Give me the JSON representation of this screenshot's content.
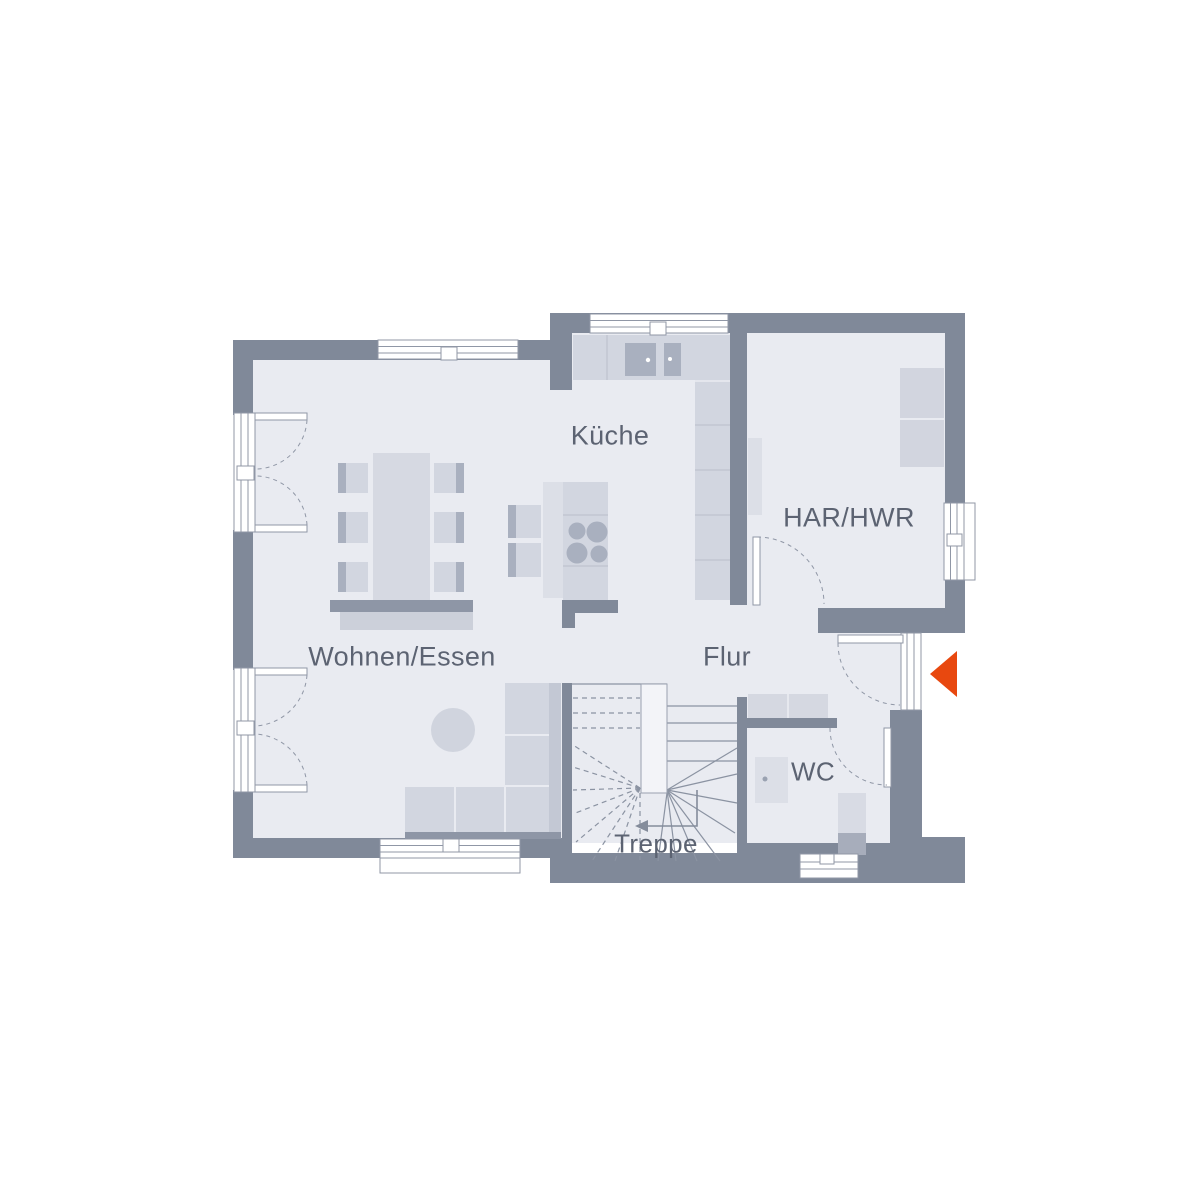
{
  "plan": {
    "type": "floor-plan-ground-floor",
    "labels": {
      "kueche": "Küche",
      "har_hwr": "HAR/HWR",
      "wohnen_essen": "Wohnen/Essen",
      "flur": "Flur",
      "wc": "WC",
      "treppe": "Treppe"
    },
    "colors": {
      "wall": "#808999",
      "floor": "#e9ebf1",
      "furniture_light": "#d2d6e0",
      "furniture_accent": "#a9b0bf",
      "base_dark": "#8e96a6",
      "entrance_arrow": "#e8480f",
      "label_text": "#5c6372"
    },
    "icons": {
      "entrance_arrow": "entrance-direction-arrow",
      "stair_direction_arrow": "stair-up-arrow"
    }
  }
}
